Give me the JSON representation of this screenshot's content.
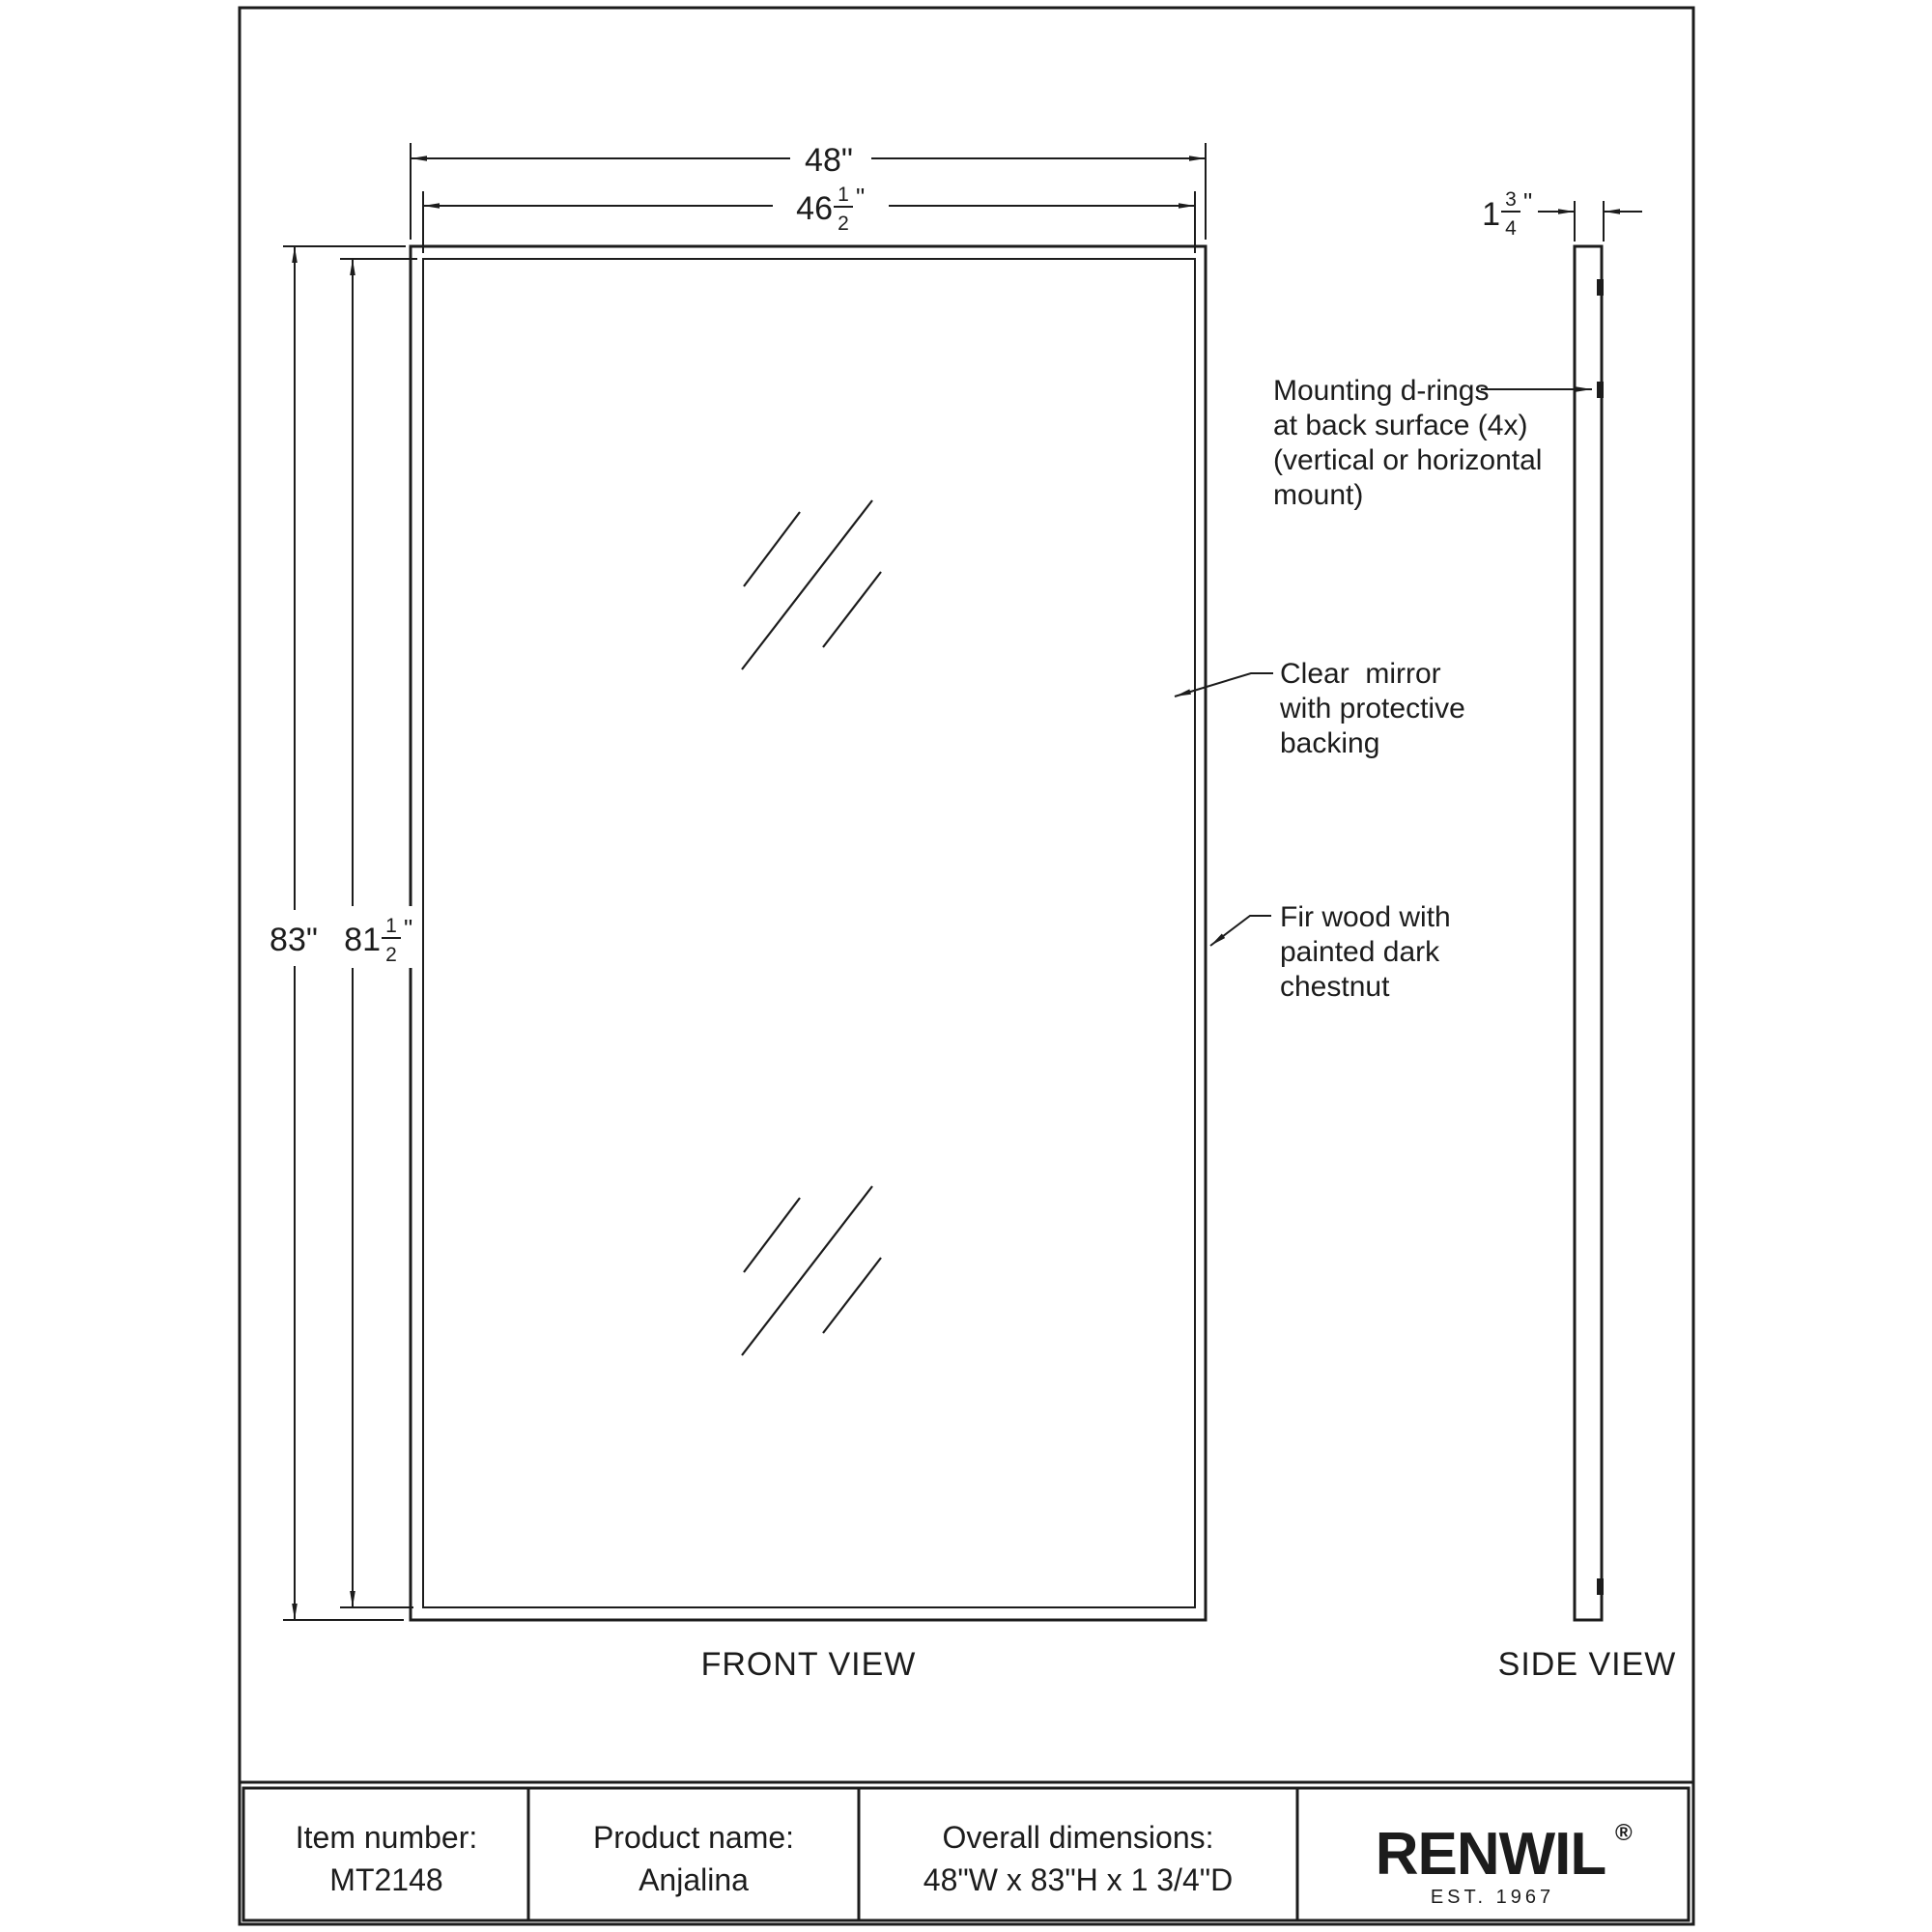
{
  "colors": {
    "ink": "#1c1c1c",
    "paper": "#ffffff"
  },
  "dimensions": {
    "width_outer": "48\"",
    "width_inner": {
      "whole": "46",
      "num": "1",
      "den": "2",
      "unit": "\""
    },
    "height_outer": "83\"",
    "height_inner": {
      "whole": "81",
      "num": "1",
      "den": "2",
      "unit": "\""
    },
    "depth": {
      "whole": "1",
      "num": "3",
      "den": "4",
      "unit": "\""
    }
  },
  "annotations": {
    "mounting": {
      "lines": [
        "Mounting d-rings",
        "at back surface (4x)",
        "(vertical or horizontal",
        "mount)"
      ]
    },
    "mirror": {
      "lines": [
        "Clear  mirror",
        "with protective",
        "backing"
      ]
    },
    "wood": {
      "lines": [
        "Fir wood with",
        "painted dark",
        "chestnut"
      ]
    }
  },
  "views": {
    "front": "FRONT VIEW",
    "side": "SIDE VIEW"
  },
  "title_block": {
    "item_label": "Item number:",
    "item_value": "MT2148",
    "product_label": "Product name:",
    "product_value": "Anjalina",
    "overall_label": "Overall dimensions:",
    "overall_value": "48\"W x 83\"H x 1 3/4\"D",
    "brand": "RENWIL",
    "brand_registered": "®",
    "brand_tagline": "EST. 1967"
  }
}
